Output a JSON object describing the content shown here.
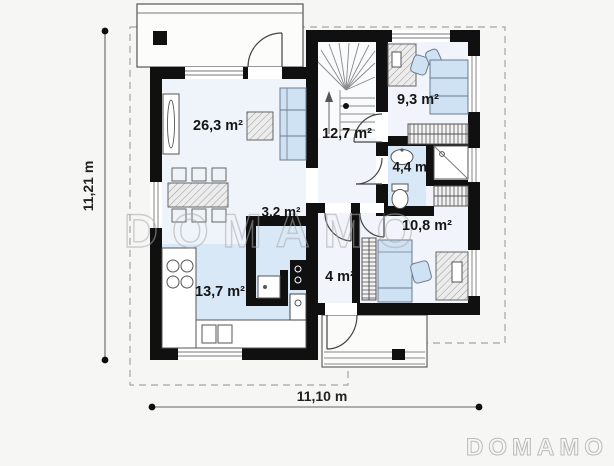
{
  "watermark": {
    "center_text": "DOMAMO",
    "corner_text": "DOMAMO"
  },
  "dimensions": {
    "vertical_label": "11,21 m",
    "horizontal_label": "11,10 m"
  },
  "rooms": [
    {
      "id": "living-room",
      "area_label": "26,3 m²"
    },
    {
      "id": "hall-staircase",
      "area_label": "12,7 m²"
    },
    {
      "id": "bedroom-upper",
      "area_label": "9,3 m²"
    },
    {
      "id": "bathroom",
      "area_label": "4,4 m²"
    },
    {
      "id": "bedroom-lower",
      "area_label": "10,8 m²"
    },
    {
      "id": "utility-room",
      "area_label": "3,2 m²"
    },
    {
      "id": "entry-hall",
      "area_label": "4 m²"
    },
    {
      "id": "kitchen",
      "area_label": "13,7 m²"
    }
  ],
  "colors": {
    "wall": "#101010",
    "room_fill_blue": "#d9e8f6",
    "room_fill_pale": "#eff4fa",
    "furniture_blue": "#cfe2f3",
    "watermark_gray": "#ababab"
  }
}
